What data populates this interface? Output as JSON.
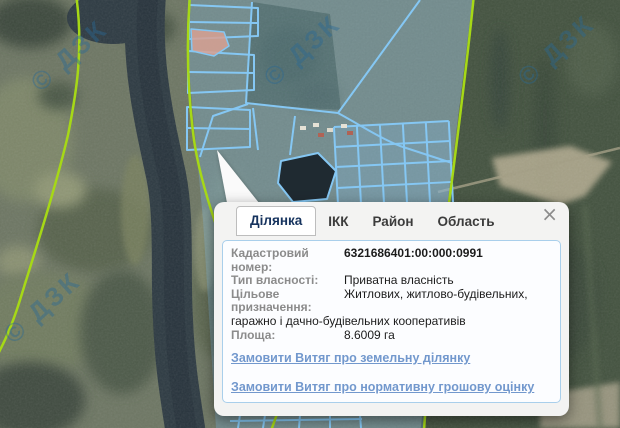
{
  "map": {
    "watermark_text": "© ДЗК",
    "colors": {
      "boundary_green": "#a6d816",
      "parcel_stroke": "#85c7f3",
      "parcel_fill": "rgba(130,190,235,0.30)",
      "selected_parcel_pink": "#d8a193"
    }
  },
  "popup": {
    "close_icon": "×",
    "tabs": [
      {
        "label": "Ділянка",
        "active": true
      },
      {
        "label": "ІКК",
        "active": false
      },
      {
        "label": "Район",
        "active": false
      },
      {
        "label": "Область",
        "active": false
      }
    ],
    "fields": [
      {
        "label": "Кадастровий номер:",
        "value": "6321686401:00:000:0991"
      },
      {
        "label": "Тип власності:",
        "value": "Приватна власність"
      },
      {
        "label": "Цільове призначення:",
        "value": "Житлових, житлово-будівельних, гаражно і дачно-будівельних кооперативів"
      },
      {
        "label": "Площа:",
        "value": "8.6009 га"
      }
    ],
    "links": [
      "Замовити Витяг про земельну ділянку",
      "Замовити Витяг про нормативну грошову оцінку",
      "Інформація про право власності та речові права"
    ]
  }
}
